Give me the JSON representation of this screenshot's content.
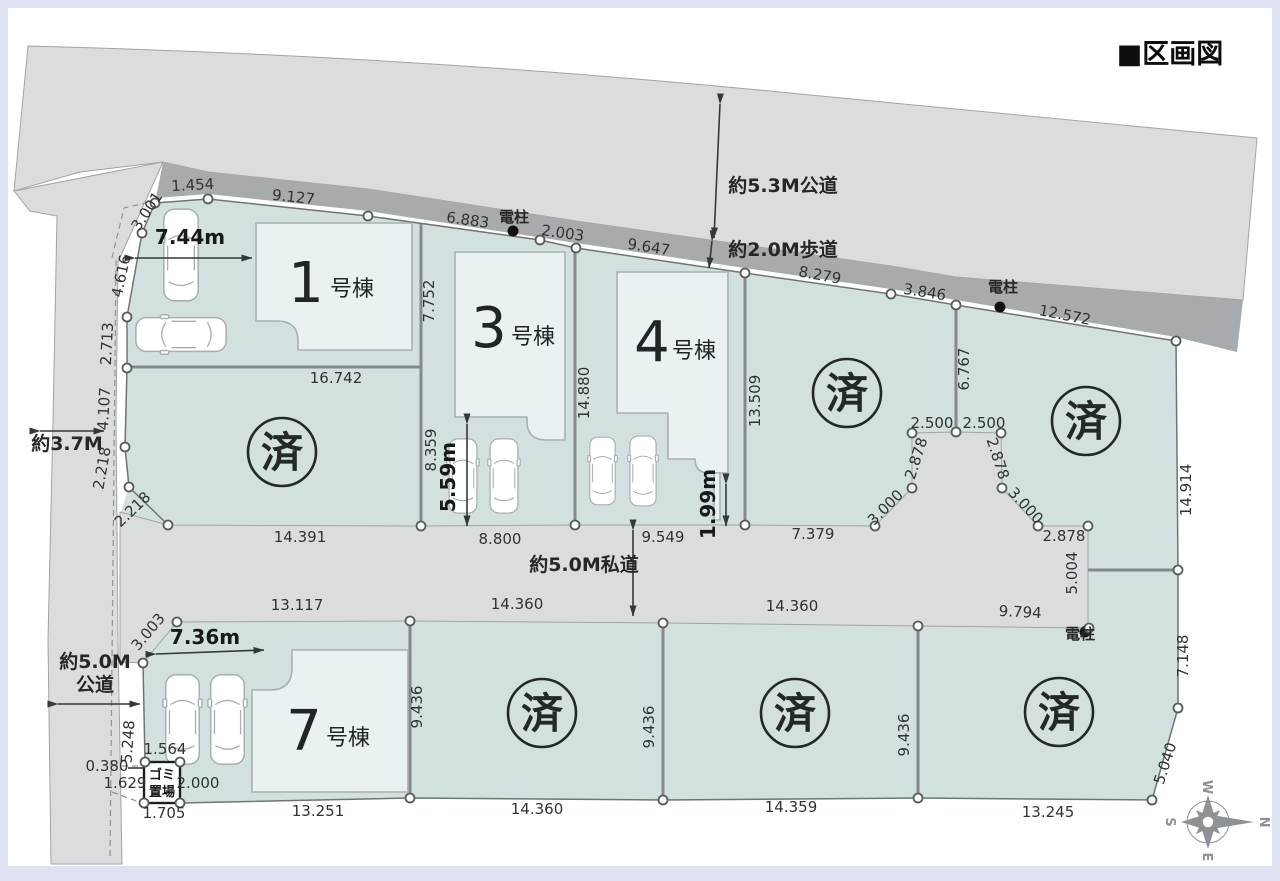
{
  "title": "■区画図",
  "roads": {
    "top_road": "約5.3M公道",
    "sidewalk": "約2.0M歩道",
    "west_road": "約3.7M",
    "sw_road_line1": "約5.0M",
    "sw_road_line2": "公道",
    "private_road": "約5.0M私道"
  },
  "pole_label": "電柱",
  "sold_mark": "済",
  "buildings": {
    "b1_num": "1",
    "b3_num": "3",
    "b4_num": "4",
    "b7_num": "7",
    "unit_suffix": "号棟"
  },
  "parking": {
    "b1_width": "7.44m",
    "b3_depth": "5.59m",
    "b4_gap": "1.99m",
    "b7_width": "7.36m"
  },
  "garbage": {
    "line1": "ゴミ",
    "line2": "置場"
  },
  "compass": {
    "north": "N",
    "south": "S",
    "east": "E",
    "west": "W"
  },
  "dims": {
    "top_a": "1.454",
    "top_b": "9.127",
    "top_c": "6.883",
    "top_d": "2.003",
    "top_e": "9.647",
    "top_f": "8.279",
    "top_g": "3.846",
    "top_h": "12.572",
    "left_a": "3.001",
    "left_b": "4.616",
    "left_c": "2.713",
    "left_d": "4.107",
    "left_e": "2.218",
    "left_f": "2.218",
    "lot1_mid": "16.742",
    "lot1_bottom": "14.391",
    "lot3_left_upper": "7.752",
    "lot3_left_lower": "8.359",
    "lot3_right": "14.880",
    "lot3_bottom": "8.800",
    "lot4_bottom": "9.549",
    "lot4_right": "13.509",
    "lot5_bottom": "7.379",
    "hh_top_l": "2.500",
    "hh_top_r": "2.500",
    "hh_side_l": "2.878",
    "hh_side_r": "2.878",
    "hh_diag_l": "3.000",
    "hh_diag_r": "3.000",
    "hh_bottom_r": "2.878",
    "hh_right": "5.004",
    "lot6_left": "6.767",
    "lot6_right": "14.914",
    "prb_a": "13.117",
    "prb_b": "14.360",
    "prb_c": "14.360",
    "prb_d": "9.794",
    "div_a": "9.436",
    "div_b": "9.436",
    "div_c": "9.436",
    "lot7_diag": "3.003",
    "lot7_left": "5.248",
    "lot7_bottom": "13.251",
    "lot8_bottom": "14.360",
    "lot9_bottom": "14.359",
    "lot10_bottom": "13.245",
    "lot10_right": "7.148",
    "lot10_diag": "5.040",
    "g_top": "1.564",
    "g_left_a": "0.380",
    "g_left_b": "1.629",
    "g_right": "2.000",
    "g_bottom": "1.705"
  }
}
